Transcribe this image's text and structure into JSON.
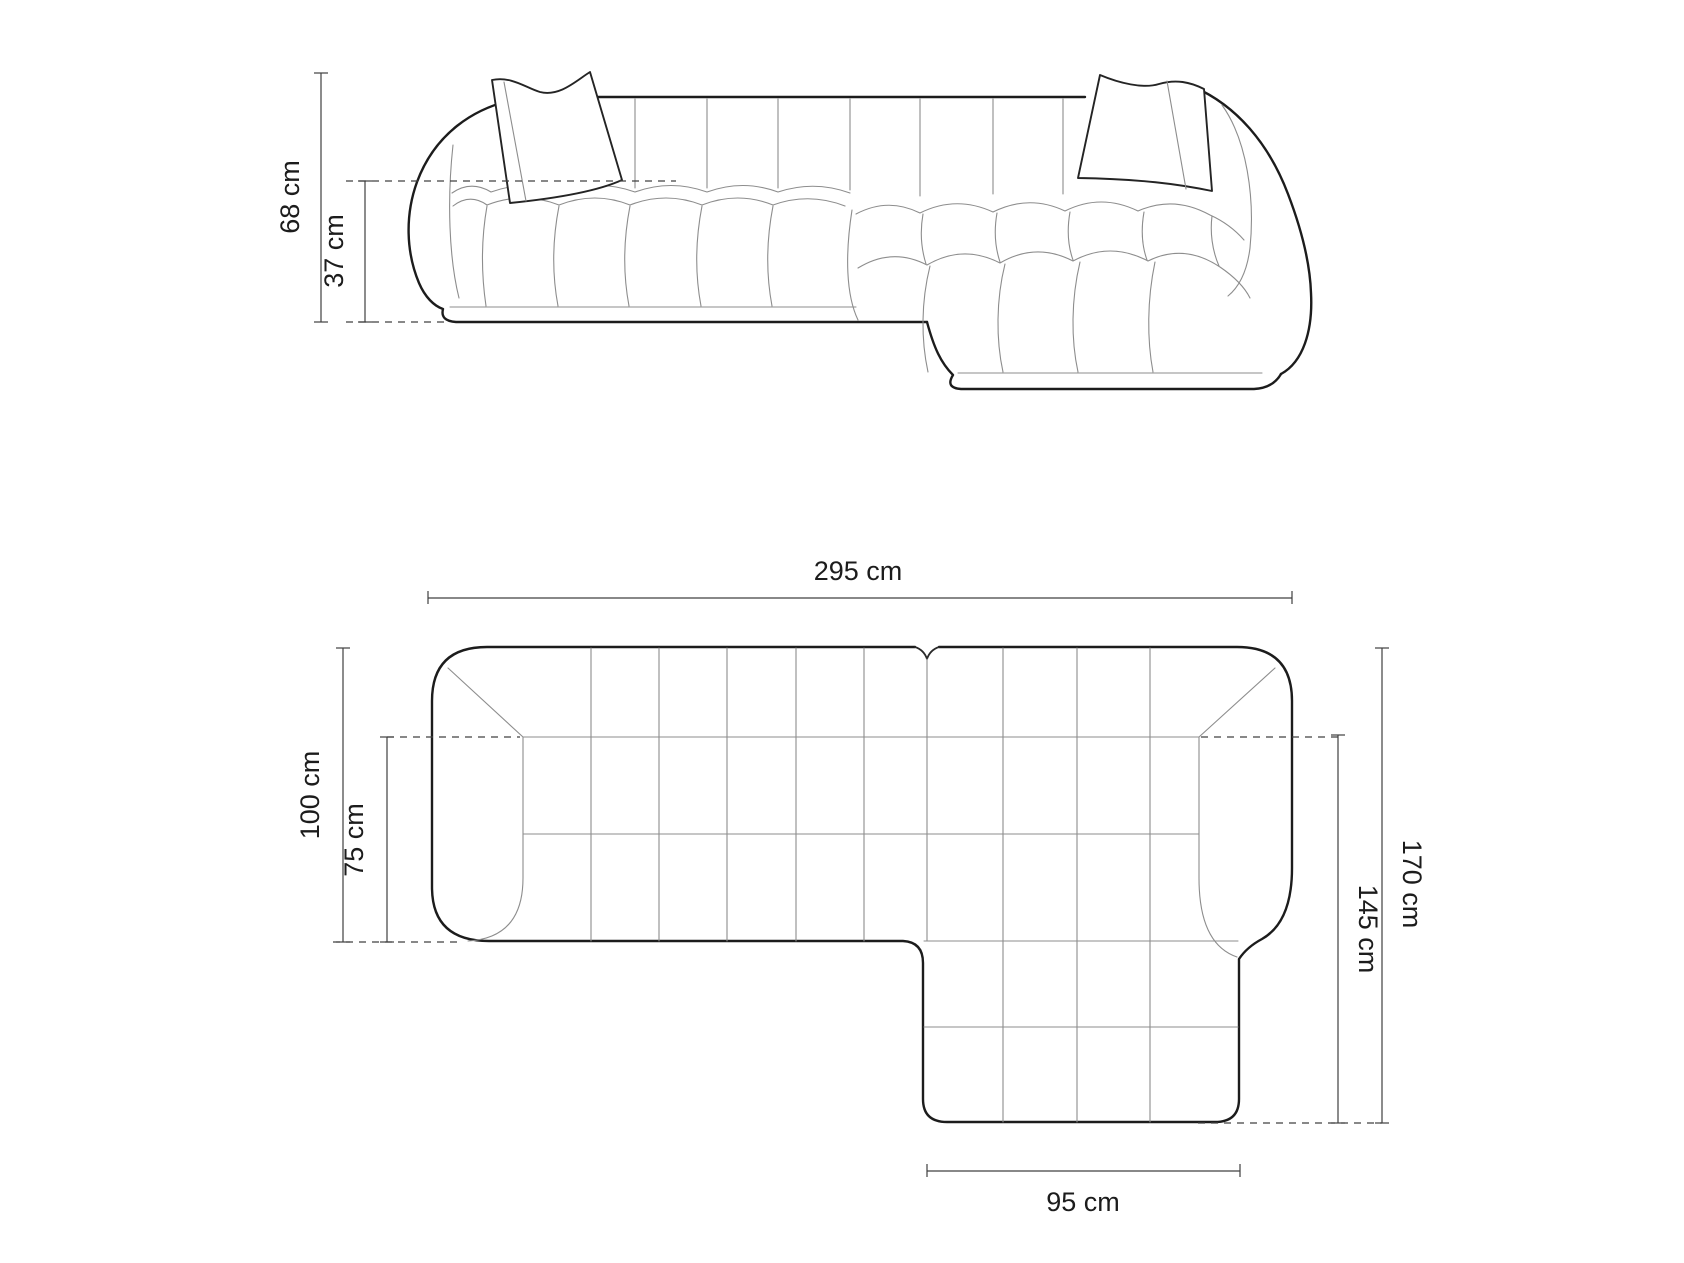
{
  "diagram": {
    "background": "#ffffff",
    "colors": {
      "outline": "#1c1c1c",
      "seam_line": "#8d8d8d",
      "dimension_line": "#404040",
      "label_text": "#1c1c1c"
    },
    "front_view": {
      "height_label": "68 cm",
      "seat_height_label": "37 cm"
    },
    "top_view": {
      "width_label": "295 cm",
      "depth_label": "100 cm",
      "seat_depth_label": "75 cm",
      "total_depth_with_chaise_label": "170 cm",
      "chaise_depth_label": "145 cm",
      "chaise_width_label": "95 cm"
    }
  }
}
